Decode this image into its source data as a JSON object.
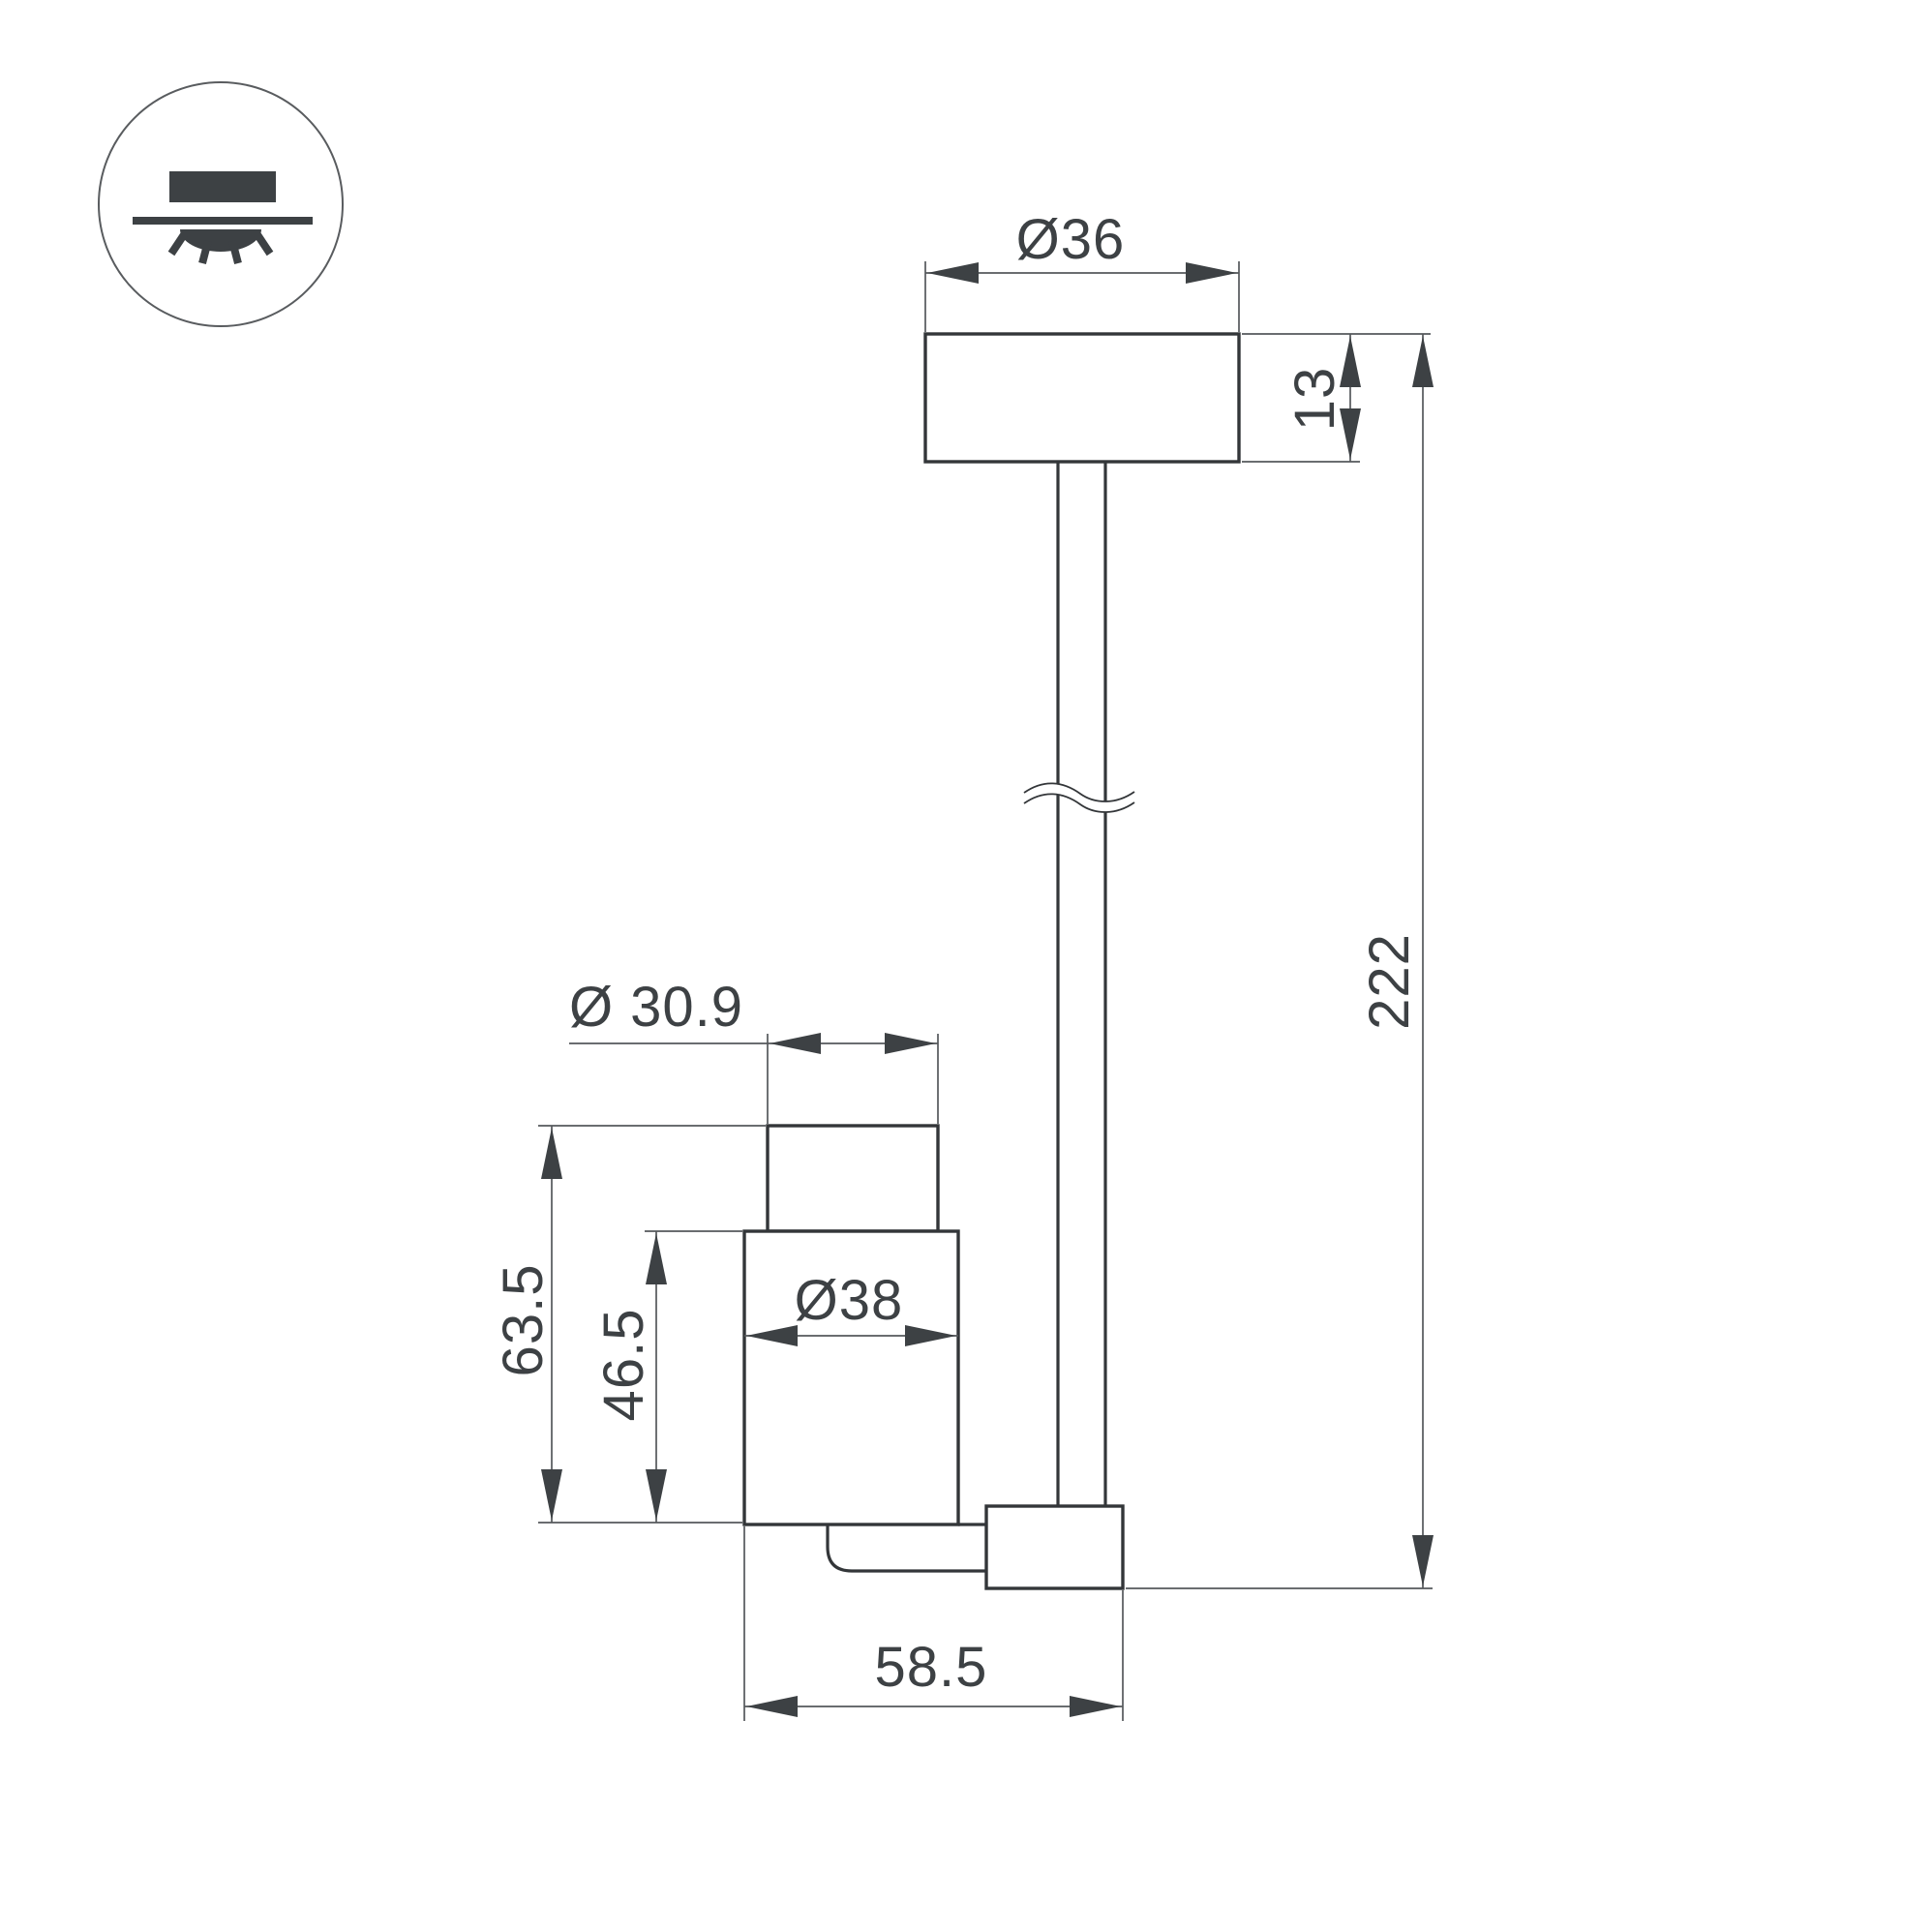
{
  "drawing": {
    "type": "technical-dimension-drawing",
    "icons": {
      "mount_type": "ceiling-surface-light-icon"
    },
    "colors": {
      "background": "#ffffff",
      "object_line": "#333639",
      "thin_line": "#55585b",
      "arrow_fill": "#3d4144",
      "text_color": "#3d4144"
    },
    "dimensions": {
      "canopy_diameter": "Ø36",
      "canopy_height": "13",
      "suspension_length": "222",
      "head_top_diameter": "Ø 30.9",
      "head_total_height": "63.5",
      "head_body_height": "46.5",
      "head_body_diameter": "Ø38",
      "head_total_width": "58.5"
    }
  }
}
